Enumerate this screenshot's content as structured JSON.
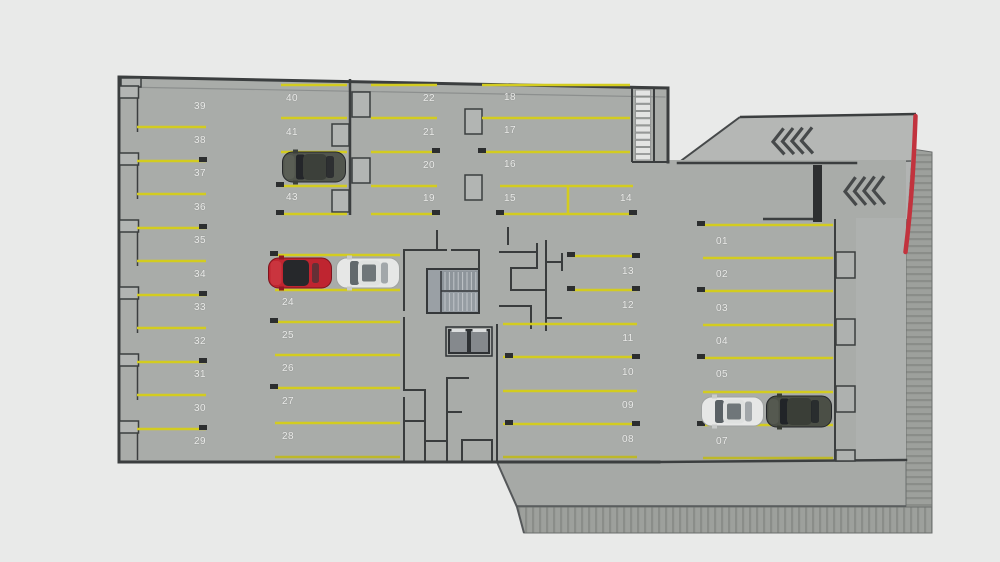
{
  "plan": {
    "columns": {
      "left": [
        "39",
        "38",
        "37",
        "36",
        "35",
        "34",
        "33",
        "32",
        "31",
        "30",
        "29"
      ],
      "upper_mid": [
        "40",
        "41",
        "43"
      ],
      "lower_mid": [
        "24",
        "25",
        "26",
        "27",
        "28"
      ],
      "center_left": [
        "22",
        "21",
        "20",
        "19"
      ],
      "center_right": [
        "18",
        "17",
        "16",
        "15",
        "14"
      ],
      "lower_center": [
        "13",
        "12",
        "11",
        "10",
        "09",
        "08"
      ],
      "right": [
        "01",
        "02",
        "03",
        "04",
        "05",
        "07"
      ]
    },
    "spots_labeled_visible": 40
  },
  "cars": [
    {
      "name": "dark-car-upper-left",
      "color_key": "car_dark"
    },
    {
      "name": "red-car-center",
      "color_key": "car_red"
    },
    {
      "name": "white-car-center",
      "color_key": "car_white"
    },
    {
      "name": "white-car-right",
      "color_key": "car_white"
    },
    {
      "name": "dark-car-right",
      "color_key": "car_dark"
    }
  ],
  "ramps": {
    "count": 2,
    "chevrons_per_ramp": 4,
    "direction": "left"
  },
  "stairs": {
    "stairwells_visible": 2,
    "elevators_visible": 2
  },
  "colors": {
    "page_bg": "#e9eae9",
    "floor": "#a9aca9",
    "ramp_floor": "#b5b7b5",
    "line_yellow": "#d3cc20",
    "wall_dark": "#3b3e3f",
    "curb_red": "#c2333e",
    "label_text": "#ebecea",
    "car_red": "#bf2530",
    "car_white": "#e6e7e6",
    "car_dark": "#4b4f46"
  }
}
